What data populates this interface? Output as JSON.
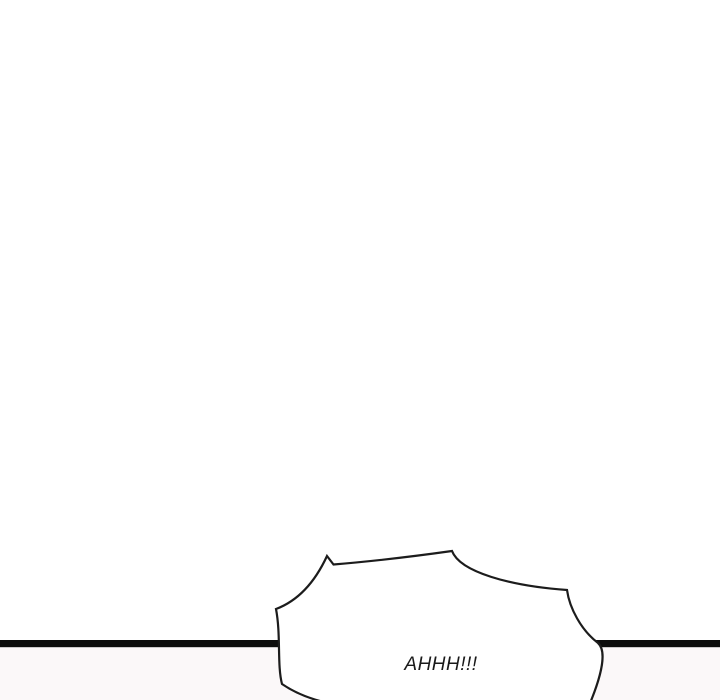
{
  "comic": {
    "bubble_text": "AHHH!!!",
    "colors": {
      "page_background": "#ffffff",
      "lower_panel_background": "#fbf8f9",
      "divider_line": "#0d0d0d",
      "bubble_fill": "#ffffff",
      "bubble_outline": "#1c1c1c",
      "text": "#1a1a1a"
    }
  }
}
